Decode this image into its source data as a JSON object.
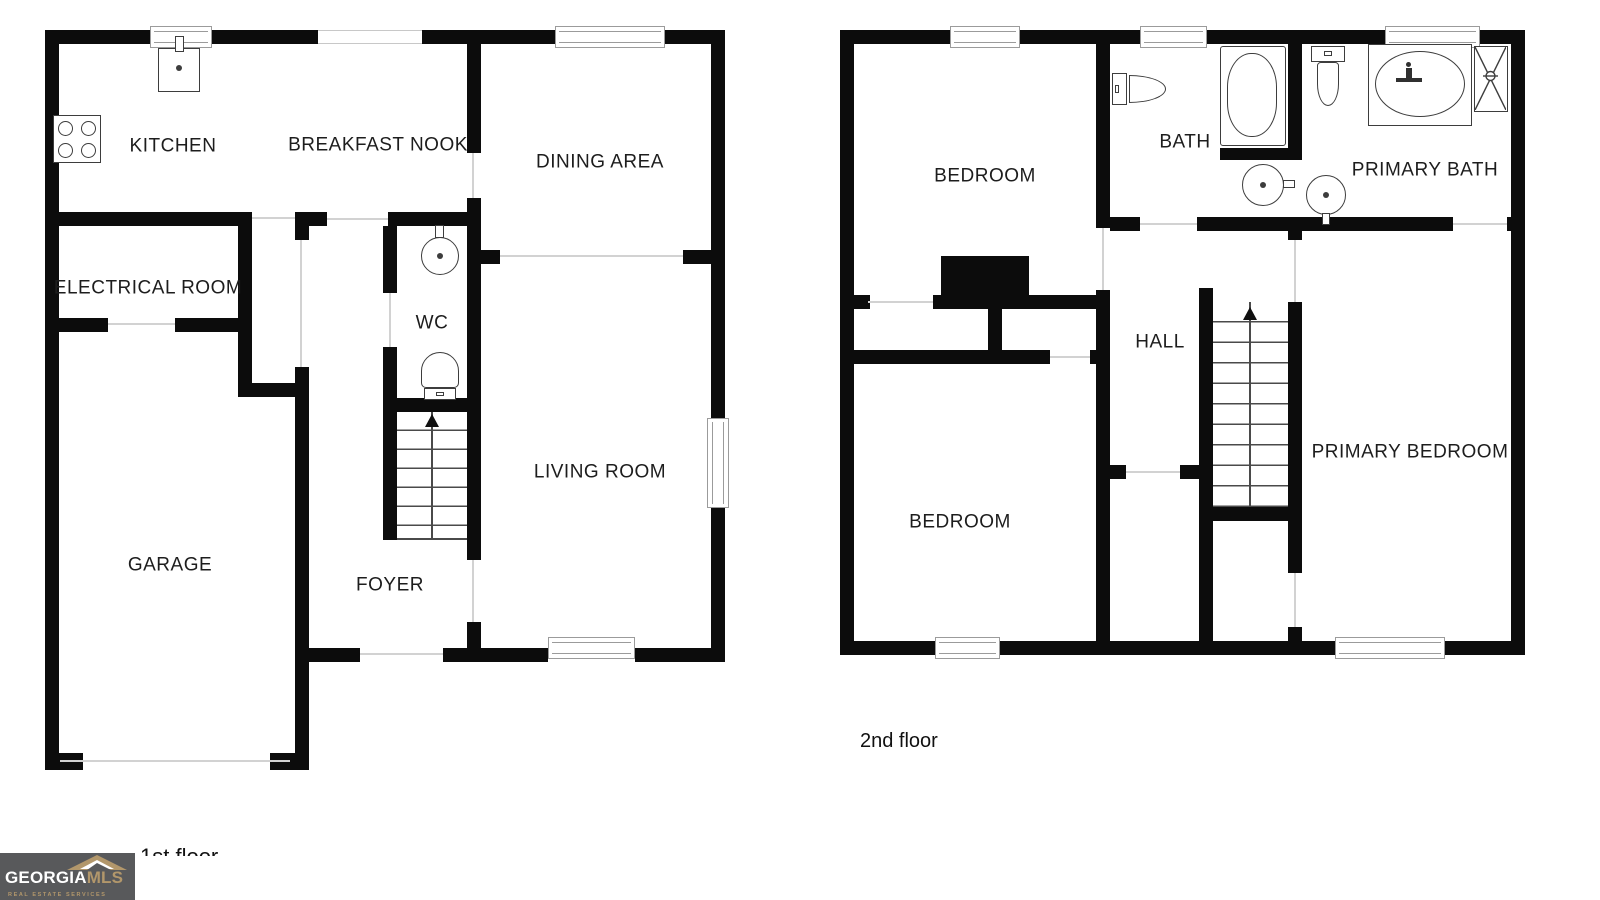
{
  "floor1": {
    "caption": "1st floor",
    "rooms": [
      {
        "label": "KITCHEN"
      },
      {
        "label": "BREAKFAST NOOK"
      },
      {
        "label": "DINING AREA"
      },
      {
        "label": "ELECTRICAL ROOM"
      },
      {
        "label": "WC"
      },
      {
        "label": "LIVING ROOM"
      },
      {
        "label": "GARAGE"
      },
      {
        "label": "FOYER"
      }
    ]
  },
  "floor2": {
    "caption": "2nd floor",
    "rooms": [
      {
        "label": "BEDROOM"
      },
      {
        "label": "BATH"
      },
      {
        "label": "PRIMARY BATH"
      },
      {
        "label": "HALL"
      },
      {
        "label": "BEDROOM"
      },
      {
        "label": "PRIMARY BEDROOM"
      }
    ]
  },
  "logo": {
    "primary": "GEORGIA",
    "secondary": "MLS",
    "tagline": "REAL ESTATE SERVICES"
  },
  "colors": {
    "wall": "#0c0c0c",
    "logo_background": "#58595b",
    "logo_gold": "#b2976b"
  }
}
